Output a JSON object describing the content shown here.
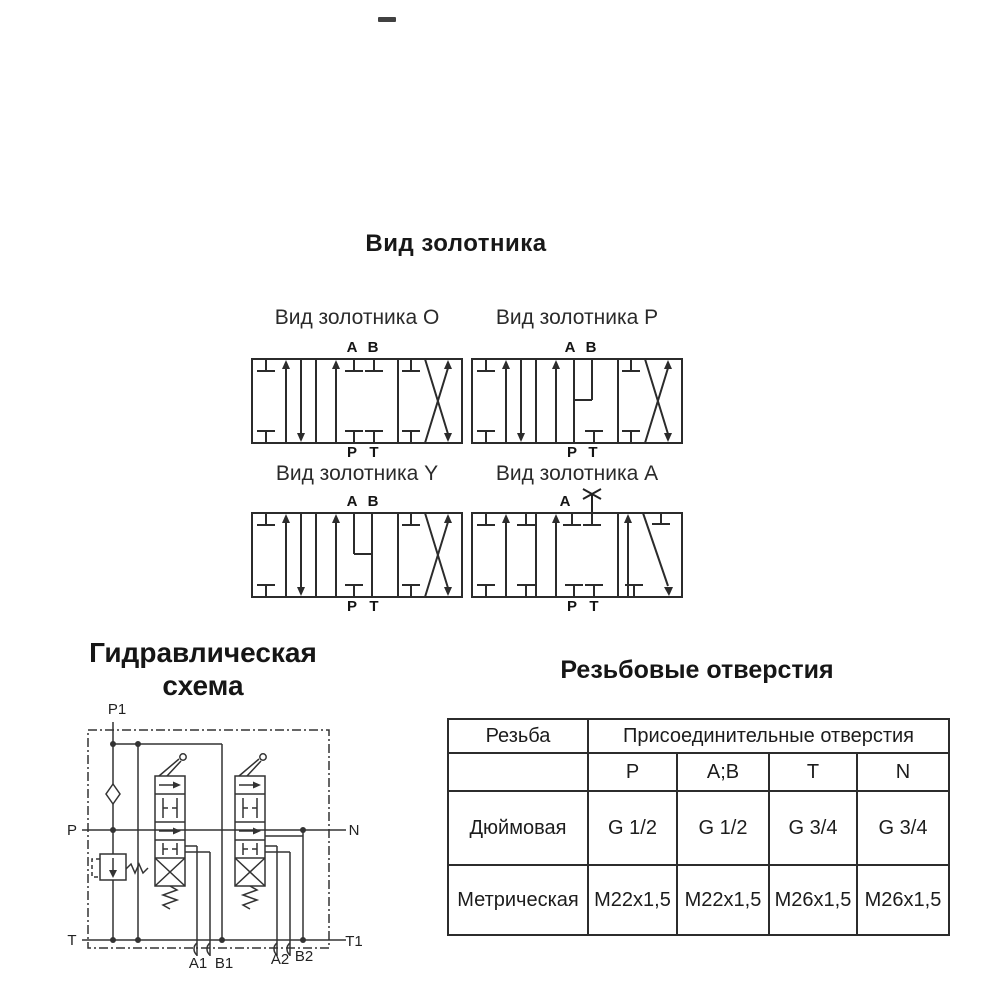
{
  "colors": {
    "line": "#2b2b2b",
    "text": "#1f1f1f"
  },
  "section_spools": {
    "title": "Вид золотника",
    "valves": [
      {
        "caption": "Вид золотника O",
        "top_ports": [
          "A",
          "B"
        ],
        "bottom_ports": [
          "P",
          "T"
        ]
      },
      {
        "caption": "Вид золотника P",
        "top_ports": [
          "A",
          "B"
        ],
        "bottom_ports": [
          "P",
          "T"
        ]
      },
      {
        "caption": "Вид золотника Y",
        "top_ports": [
          "A",
          "B"
        ],
        "bottom_ports": [
          "P",
          "T"
        ]
      },
      {
        "caption": "Вид золотника A",
        "top_ports": [
          "A"
        ],
        "bottom_ports": [
          "P",
          "T"
        ],
        "plugged_port_icon": "crossed-port-icon"
      }
    ]
  },
  "section_schematic": {
    "title_line1": "Гидравлическая",
    "title_line2": "схема",
    "labels": {
      "p1": "P1",
      "p": "P",
      "n": "N",
      "t": "T",
      "t1": "T1",
      "a1": "A1",
      "b1": "B1",
      "a2": "A2",
      "b2": "B2"
    }
  },
  "section_table": {
    "title": "Резьбовые отверстия",
    "col1_header": "Резьба",
    "group_header": "Присоединительные отверстия",
    "port_headers": [
      "P",
      "A;B",
      "T",
      "N"
    ],
    "rows": [
      {
        "label": "Дюймовая",
        "values": [
          "G 1/2",
          "G 1/2",
          "G 3/4",
          "G 3/4"
        ]
      },
      {
        "label": "Метрическая",
        "values": [
          "M22x1,5",
          "M22x1,5",
          "M26x1,5",
          "M26x1,5"
        ]
      }
    ]
  }
}
